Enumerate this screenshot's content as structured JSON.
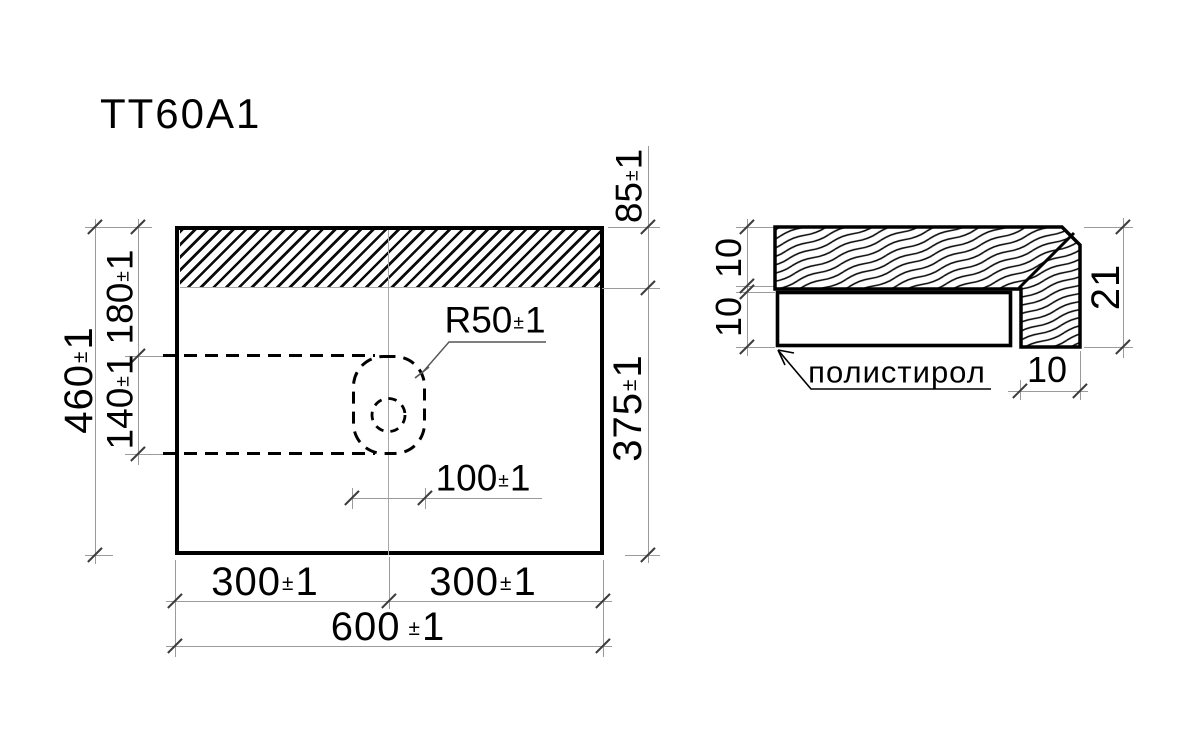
{
  "pm": "±",
  "title": "TT60A1",
  "dims": {
    "height_total": {
      "v": "460",
      "t": "1"
    },
    "left_upper": {
      "v": "180",
      "t": "1"
    },
    "left_lower": {
      "v": "140",
      "t": "1"
    },
    "right_upper": {
      "v": "85",
      "t": "1"
    },
    "right_lower": {
      "v": "375",
      "t": "1"
    },
    "radius": {
      "v": "R50",
      "t": "1"
    },
    "hole_offset": {
      "v": "100",
      "t": "1"
    },
    "bottom_left": {
      "v": "300",
      "t": "1"
    },
    "bottom_right": {
      "v": "300",
      "t": "1"
    },
    "bottom_total": {
      "v": "600",
      "t": "1"
    }
  },
  "section": {
    "material_label": "полистирол",
    "dims": {
      "top_thickness": {
        "v": "10"
      },
      "foam_thickness": {
        "v": "10"
      },
      "total_thickness": {
        "v": "21"
      },
      "edge_width": {
        "v": "10"
      }
    }
  }
}
